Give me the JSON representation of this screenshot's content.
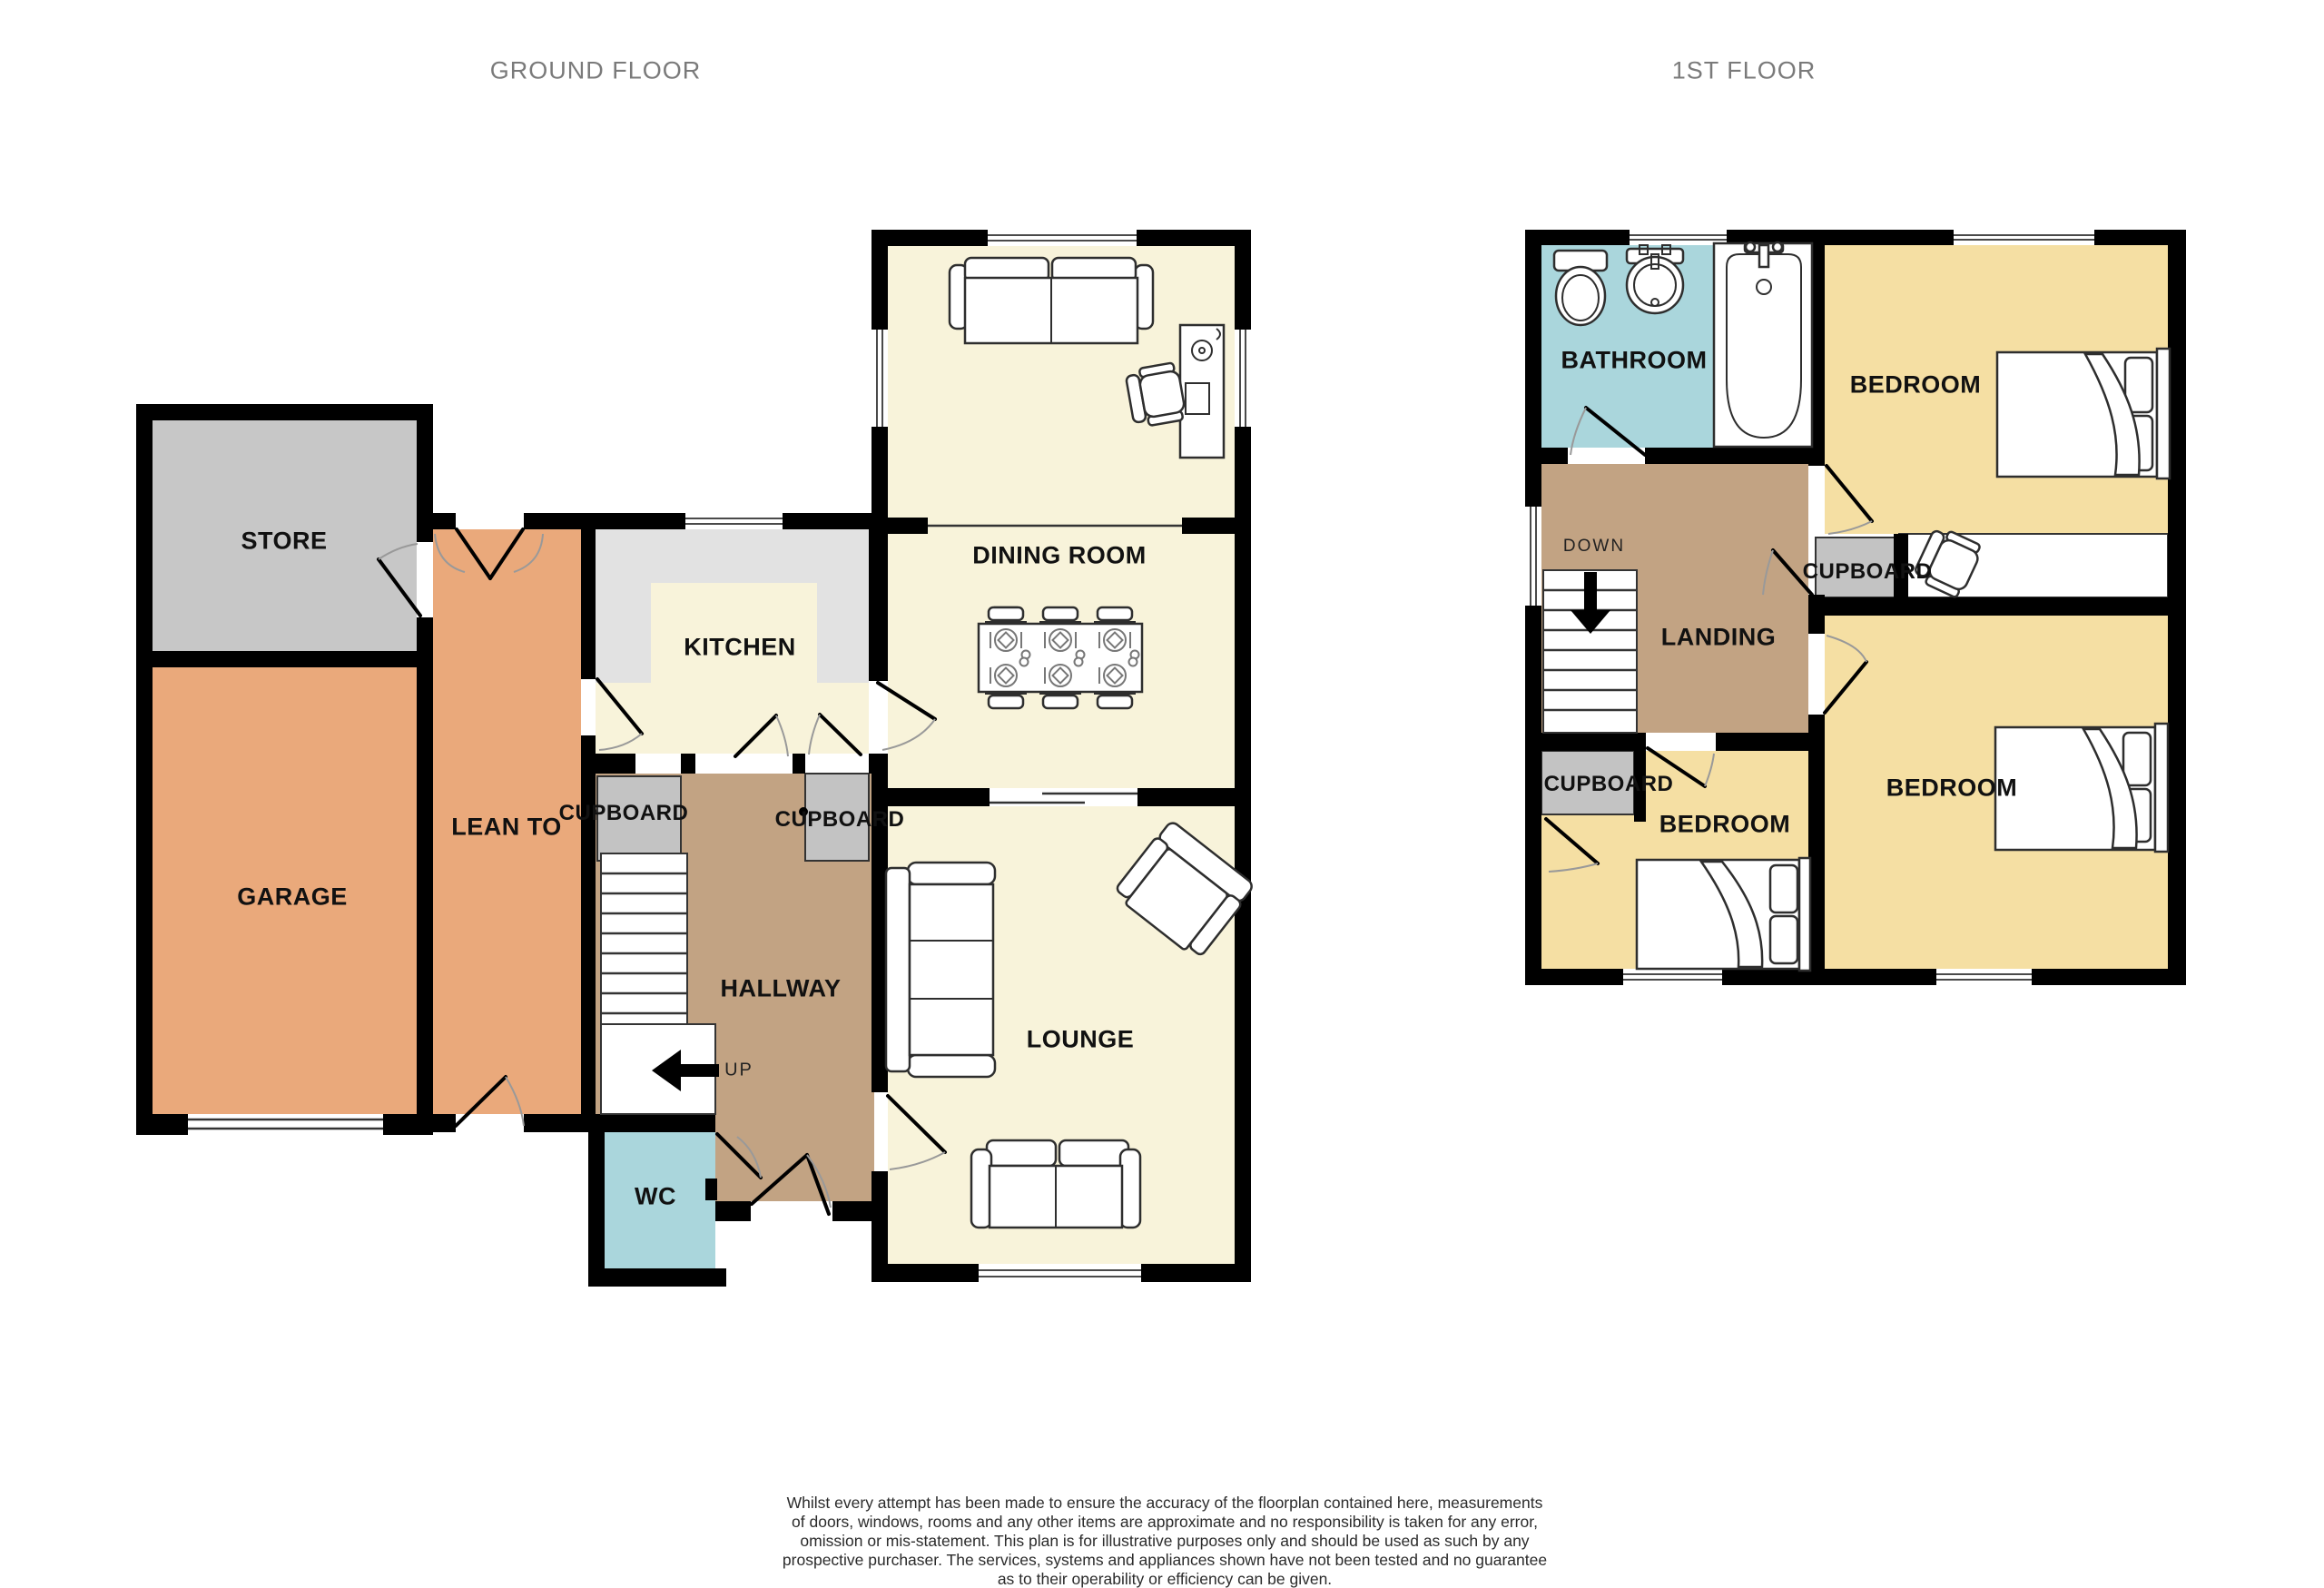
{
  "titles": {
    "ground": "GROUND FLOOR",
    "first": "1ST FLOOR"
  },
  "ground_floor": {
    "rooms": {
      "store": "STORE",
      "garage": "GARAGE",
      "lean_to": "LEAN TO",
      "kitchen": "KITCHEN",
      "cupboard_left": "CUPBOARD",
      "cupboard_right": "CUPBOARD",
      "hallway": "HALLWAY",
      "dining_room": "DINING ROOM",
      "lounge": "LOUNGE",
      "wc": "WC"
    },
    "stairs_label": "UP"
  },
  "first_floor": {
    "rooms": {
      "bathroom": "BATHROOM",
      "bedroom_front": "BEDROOM",
      "bedroom_side": "BEDROOM",
      "bedroom_back": "BEDROOM",
      "landing": "LANDING",
      "cupboard_top": "CUPBOARD",
      "cupboard_bottom": "CUPBOARD"
    },
    "stairs_label": "DOWN"
  },
  "disclaimer": {
    "line1": "Whilst every attempt has been made to ensure the accuracy of the floorplan contained here, measurements",
    "line2": "of doors, windows, rooms and any other items are approximate and no responsibility is taken for any error,",
    "line3": "omission or mis-statement. This plan is for illustrative purposes only and should be used as such by any",
    "line4": "prospective purchaser. The services, systems and appliances shown have not been tested and no guarantee",
    "line5": "as to their operability or efficiency can be given.",
    "line6": "Made with Metropix ©2025"
  },
  "icons": {
    "furniture": [
      "two-seat-sofa",
      "three-seat-sofa",
      "armchair",
      "dining-table",
      "dining-chair",
      "place-setting",
      "desk",
      "office-chair",
      "double-bed",
      "single-bed",
      "toilet",
      "sink",
      "bathtub",
      "staircase-up",
      "staircase-down",
      "up-arrow",
      "down-arrow"
    ]
  },
  "colors": {
    "wall": "#000000",
    "cream": "#f8f3da",
    "orange": "#eaa97b",
    "tan": "#c2a383",
    "store_gray": "#c7c7c7",
    "cupboard_gray": "#c3c3c3",
    "kitchen_gray": "#e2e2e2",
    "blue": "#aad6dc",
    "yellow": "#f5dfa3",
    "title_text": "#7a7a7a",
    "label_text": "#111111",
    "door_arc": "#999999",
    "furniture_stroke": "#2e2e2e"
  }
}
